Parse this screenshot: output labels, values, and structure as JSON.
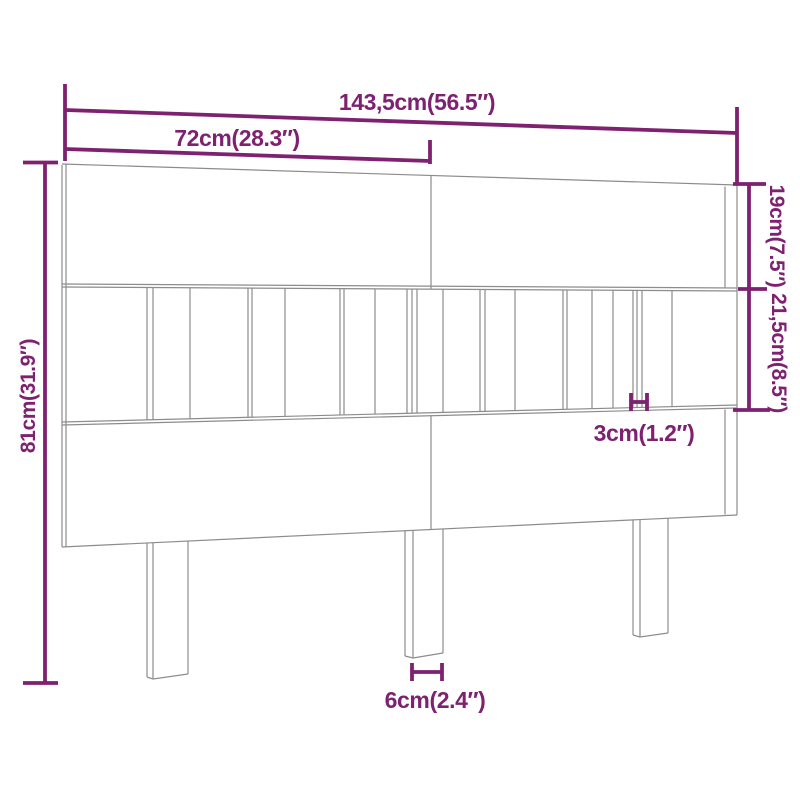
{
  "page": {
    "background": "#ffffff"
  },
  "diagram": {
    "kind": "headboard-dimension-diagram",
    "accent_color": "#7e2170",
    "outline_color": "#8c8c8c",
    "dimensions": {
      "total_width": "143,5cm(56.5″)",
      "half_width": "72cm(28.3″)",
      "top_rail_height": "19cm(7.5″)",
      "middle_section_height": "21,5cm(8.5″)",
      "total_height": "81cm(31.9″)",
      "slat_thickness": "3cm(1.2″)",
      "leg_width": "6cm(2.4″)"
    }
  }
}
